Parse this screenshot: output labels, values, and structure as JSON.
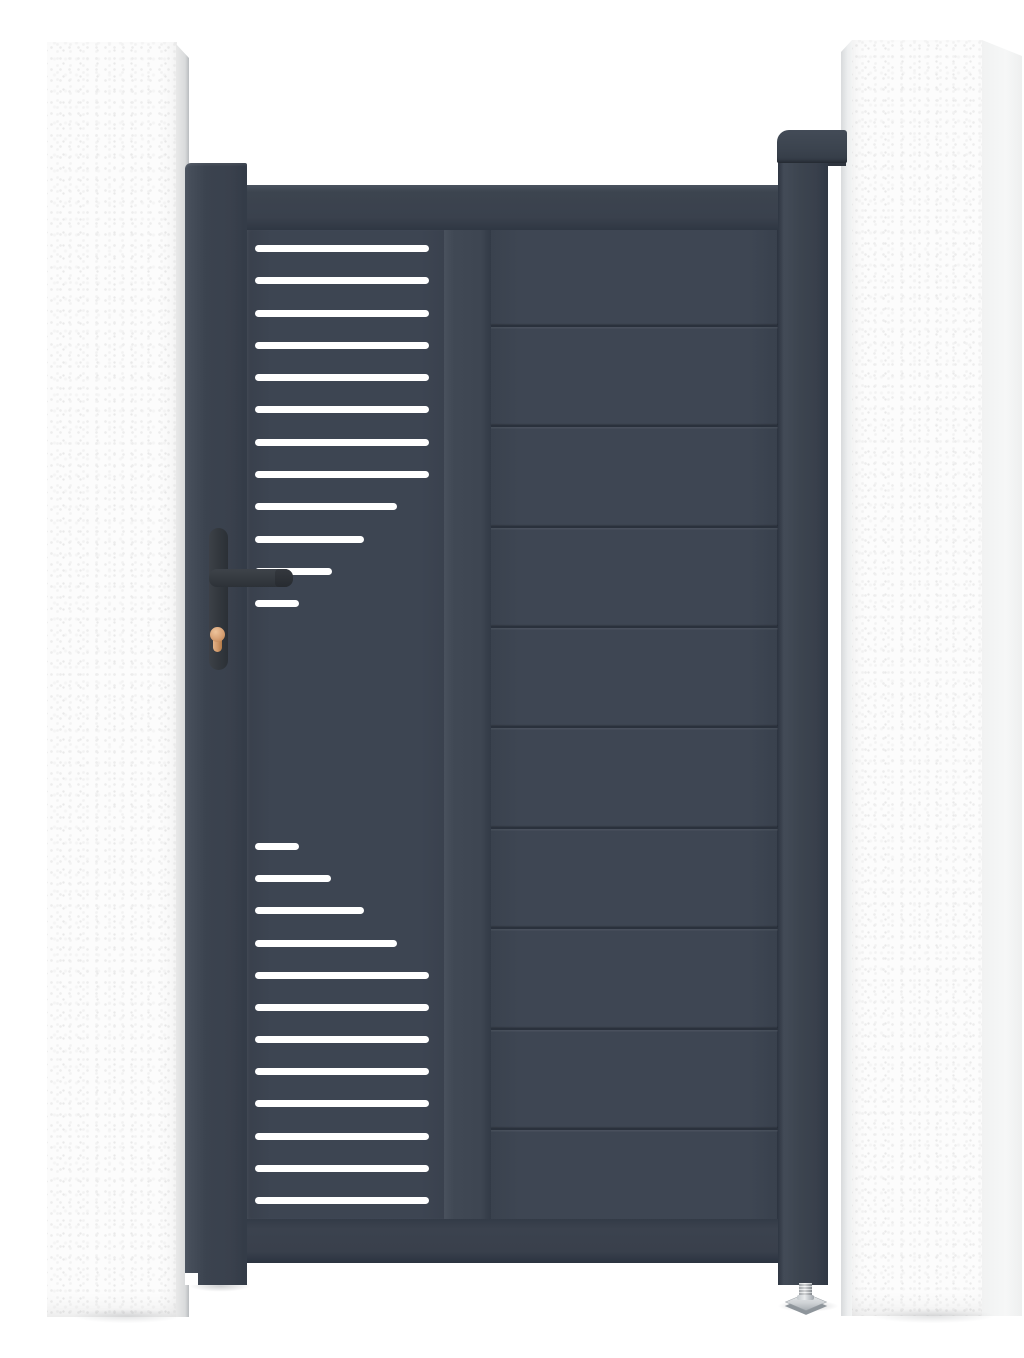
{
  "scene": {
    "description": "Product render of a modern anthracite grey aluminium pedestrian garden gate mounted between two white rendered masonry pillars on a plain white background",
    "background_color": "#ffffff",
    "text_content": "none - image contains no visible text"
  },
  "palette": {
    "gate_anthracite": "#3d4552",
    "gate_anthracite_dark": "#2e3541",
    "gate_anthracite_light": "#4a525e",
    "slat_cutout_white": "#ffffff",
    "pillar_white": "#fcfcfc",
    "pillar_shadow_grey": "#d9dbdc",
    "handle_black": "#30353c",
    "lock_cylinder_copper": "#d6a074",
    "foot_metal_silver": "#d0d4d7"
  },
  "pillars": {
    "left": {
      "x": 47,
      "y": 42,
      "width": 145,
      "height": 1275
    },
    "right": {
      "x": 841,
      "y": 40,
      "width": 181,
      "height": 1276
    }
  },
  "gate": {
    "leaf": {
      "x": 247,
      "y": 185,
      "width": 532,
      "height": 1078
    },
    "left_post": {
      "x": 185,
      "y": 163,
      "width": 62,
      "height": 1122
    },
    "right_hinge_post": {
      "x": 778,
      "y": 148,
      "width": 50,
      "height": 1137
    },
    "hinge_cap": {
      "x": 777,
      "y": 130,
      "width": 70,
      "height": 33
    },
    "left_panel": {
      "slat_height": 7,
      "slat_count": 24,
      "slats": [
        {
          "y": 248,
          "x1": 255,
          "x2": 429
        },
        {
          "y": 280,
          "x1": 255,
          "x2": 429
        },
        {
          "y": 313,
          "x1": 255,
          "x2": 429
        },
        {
          "y": 345,
          "x1": 255,
          "x2": 429
        },
        {
          "y": 377,
          "x1": 255,
          "x2": 429
        },
        {
          "y": 409,
          "x1": 255,
          "x2": 429
        },
        {
          "y": 442,
          "x1": 255,
          "x2": 429
        },
        {
          "y": 474,
          "x1": 255,
          "x2": 429
        },
        {
          "y": 506,
          "x1": 255,
          "x2": 397
        },
        {
          "y": 539,
          "x1": 255,
          "x2": 364
        },
        {
          "y": 571,
          "x1": 255,
          "x2": 332
        },
        {
          "y": 603,
          "x1": 255,
          "x2": 299
        },
        {
          "y": 846,
          "x1": 255,
          "x2": 299
        },
        {
          "y": 878,
          "x1": 255,
          "x2": 331
        },
        {
          "y": 910,
          "x1": 255,
          "x2": 364
        },
        {
          "y": 943,
          "x1": 255,
          "x2": 397
        },
        {
          "y": 975,
          "x1": 255,
          "x2": 429
        },
        {
          "y": 1007,
          "x1": 255,
          "x2": 429
        },
        {
          "y": 1039,
          "x1": 255,
          "x2": 429
        },
        {
          "y": 1071,
          "x1": 255,
          "x2": 429
        },
        {
          "y": 1103,
          "x1": 255,
          "x2": 429
        },
        {
          "y": 1136,
          "x1": 255,
          "x2": 429
        },
        {
          "y": 1168,
          "x1": 255,
          "x2": 429
        },
        {
          "y": 1200,
          "x1": 255,
          "x2": 429
        }
      ]
    },
    "right_panel": {
      "board_count": 10,
      "groove_y": [
        325,
        425,
        526,
        626,
        726,
        827,
        927,
        1028,
        1128
      ]
    },
    "handle": {
      "plate": {
        "x": 209,
        "y": 528,
        "width": 19,
        "height": 142
      },
      "lever": {
        "x": 209,
        "y": 569,
        "width": 84,
        "height": 18
      },
      "cylinder": {
        "x": 210,
        "y": 627,
        "width": 15,
        "height": 25
      }
    },
    "adjustable_foot": {
      "center_x": 806,
      "top_y": 1283,
      "plate_width": 36
    }
  }
}
